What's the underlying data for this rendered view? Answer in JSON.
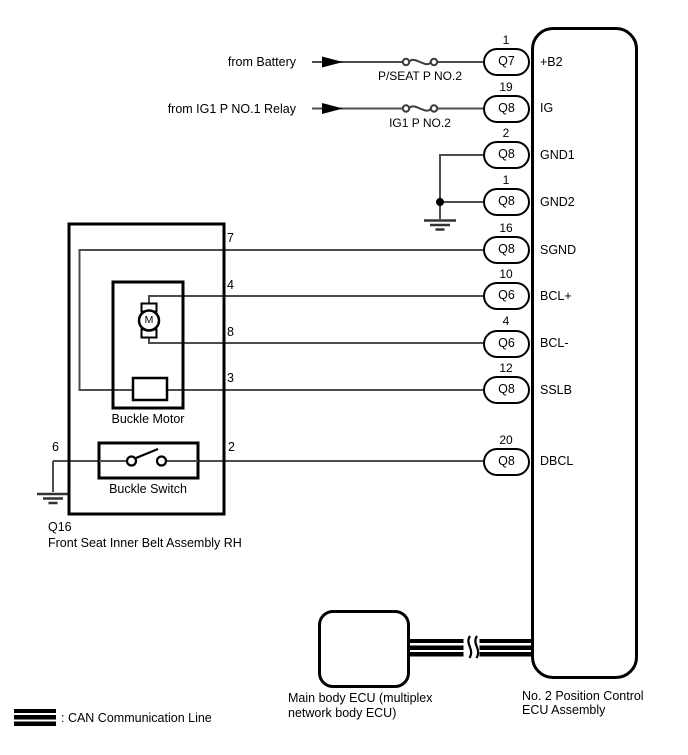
{
  "power": {
    "battery_source": "from Battery",
    "battery_fuse": "P/SEAT P NO.2",
    "ig_source": "from IG1 P NO.1 Relay",
    "ig_fuse": "IG1 P NO.2"
  },
  "ecu": {
    "label_line1": "No. 2 Position Control",
    "label_line2": "ECU Assembly",
    "pins": [
      {
        "number": "1",
        "connector": "Q7",
        "name": "+B2"
      },
      {
        "number": "19",
        "connector": "Q8",
        "name": "IG"
      },
      {
        "number": "2",
        "connector": "Q8",
        "name": "GND1"
      },
      {
        "number": "1",
        "connector": "Q8",
        "name": "GND2"
      },
      {
        "number": "16",
        "connector": "Q8",
        "name": "SGND"
      },
      {
        "number": "10",
        "connector": "Q6",
        "name": "BCL+"
      },
      {
        "number": "4",
        "connector": "Q6",
        "name": "BCL-"
      },
      {
        "number": "12",
        "connector": "Q8",
        "name": "SSLB"
      },
      {
        "number": "20",
        "connector": "Q8",
        "name": "DBCL"
      }
    ]
  },
  "assembly": {
    "connector_code": "Q16",
    "label": "Front Seat Inner Belt Assembly RH",
    "motor_label": "Buckle Motor",
    "motor_symbol": "M",
    "switch_label": "Buckle Switch",
    "terminals": {
      "sgnd": "7",
      "bcl_plus": "4",
      "bcl_minus": "8",
      "sslb": "3",
      "dbcl": "2",
      "ground": "6"
    }
  },
  "main_body_ecu": {
    "label_line1": "Main body ECU (multiplex",
    "label_line2": "network body ECU)"
  },
  "legend": {
    "can_label": ": CAN Communication Line"
  },
  "colors": {
    "line": "#000000",
    "wire": "#4d4d4d",
    "background": "#ffffff"
  }
}
